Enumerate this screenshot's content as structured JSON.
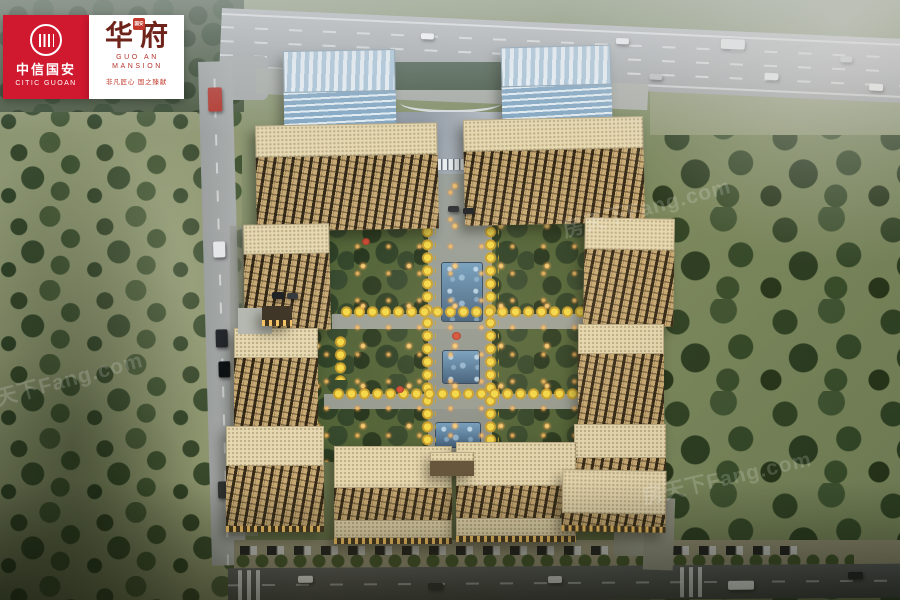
{
  "branding": {
    "citic": {
      "name_cn": "中信国安",
      "name_en": "CITIC GUOAN",
      "emblem": "citic-circle-monogram",
      "bg_color": "#d0182f"
    },
    "mansion": {
      "title": "华府",
      "seal_text": "国安",
      "subtitle_line1": "GUO AN",
      "subtitle_line2": "MANSION",
      "tagline": "非凡匠心 国之臻献",
      "title_color": "#6e241a",
      "accent_color": "#b5342c"
    }
  },
  "watermark": {
    "text": "房天下Fang.com"
  },
  "scene": {
    "subject": "aerial-rendering-of-residential-complex",
    "palette": {
      "road": "#9da1a2",
      "road_dark": "#45484a",
      "grass": "#7c8a5e",
      "tree": "#324525",
      "building_tan": "#c7a974",
      "roof_beige": "#e6d9b2",
      "glass_blue": "#9fc0d8",
      "pool_blue": "#3f6b94",
      "golden_tree": "#eecf3e",
      "light_glow": "#ffb95e"
    }
  }
}
